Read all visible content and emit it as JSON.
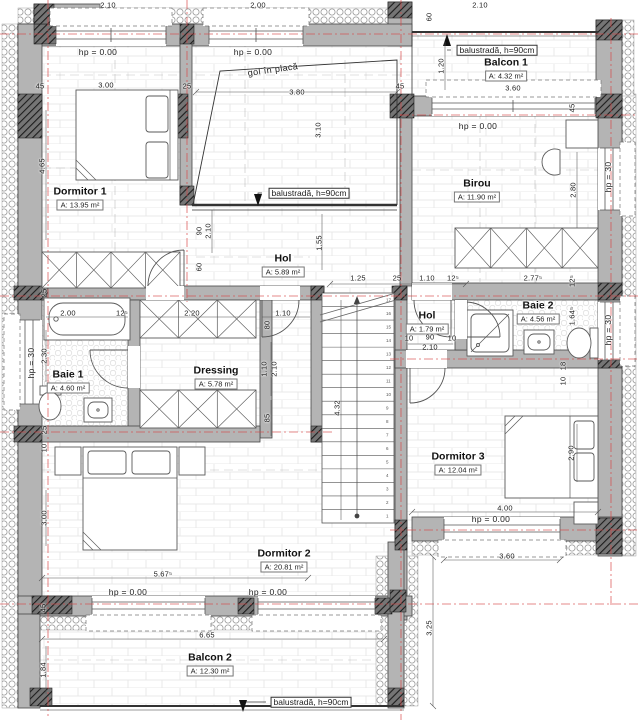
{
  "plan": {
    "title": "etaj floor plan",
    "rooms": [
      {
        "name": "Dormitor 1",
        "area": "A: 13.95 m²",
        "cx": 80,
        "cy": 198
      },
      {
        "name": "Balcon 1",
        "area": "A: 4.32 m²",
        "cx": 506,
        "cy": 69
      },
      {
        "name": "Birou",
        "area": "A: 11.90 m²",
        "cx": 477,
        "cy": 190
      },
      {
        "name": "Hol",
        "area": "A: 5.89 m²",
        "cx": 283,
        "cy": 265
      },
      {
        "name": "Baie 1",
        "area": "A: 4.60 m²",
        "cx": 68,
        "cy": 381
      },
      {
        "name": "Dressing",
        "area": "A: 5.78 m²",
        "cx": 216,
        "cy": 377
      },
      {
        "name": "Hol",
        "area": "A: 1.79 m²",
        "cx": 427,
        "cy": 322
      },
      {
        "name": "Baie 2",
        "area": "A: 4.56 m²",
        "cx": 538,
        "cy": 312
      },
      {
        "name": "Dormitor 3",
        "area": "A: 12.04 m²",
        "cx": 458,
        "cy": 463
      },
      {
        "name": "Dormitor 2",
        "area": "A: 20.81 m²",
        "cx": 284,
        "cy": 560
      },
      {
        "name": "Balcon 2",
        "area": "A: 12.30 m²",
        "cx": 210,
        "cy": 664
      }
    ],
    "labels": [
      {
        "t": "2.10",
        "x": 108,
        "y": 5,
        "cls": "dim"
      },
      {
        "t": "2.00",
        "x": 258,
        "y": 5,
        "cls": "dim"
      },
      {
        "t": "2.10",
        "x": 480,
        "y": 5,
        "cls": "dim"
      },
      {
        "t": "45",
        "x": 40,
        "y": 86,
        "cls": "dim"
      },
      {
        "t": "3.00",
        "x": 106,
        "y": 85,
        "cls": "dim"
      },
      {
        "t": "25",
        "x": 187,
        "y": 86,
        "cls": "dim"
      },
      {
        "t": "3.80",
        "x": 297,
        "y": 92,
        "cls": "dim"
      },
      {
        "t": "45",
        "x": 400,
        "y": 86,
        "cls": "dim"
      },
      {
        "t": "60",
        "x": 429,
        "y": 17,
        "r": -90,
        "cls": "dim"
      },
      {
        "t": "1.20",
        "x": 441,
        "y": 66,
        "r": -90,
        "cls": "dim"
      },
      {
        "t": "3.60",
        "x": 513,
        "y": 88,
        "cls": "dim"
      },
      {
        "t": "45",
        "x": 572,
        "y": 108,
        "r": -90,
        "cls": "dim"
      },
      {
        "t": "4.65",
        "x": 42,
        "y": 166,
        "r": -90,
        "cls": "dim"
      },
      {
        "t": "3.10",
        "x": 318,
        "y": 130,
        "r": -90,
        "cls": "dim"
      },
      {
        "t": "2.80",
        "x": 573,
        "y": 190,
        "r": -90,
        "cls": "dim"
      },
      {
        "t": "90",
        "x": 199,
        "y": 231,
        "r": -90,
        "cls": "dim"
      },
      {
        "t": "2.10",
        "x": 208,
        "y": 231,
        "r": -90,
        "cls": "dim"
      },
      {
        "t": "60",
        "x": 199,
        "y": 267,
        "r": -90,
        "cls": "dim"
      },
      {
        "t": "1.55",
        "x": 319,
        "y": 243,
        "r": -90,
        "cls": "dim"
      },
      {
        "t": "1.25",
        "x": 358,
        "y": 278,
        "cls": "dim"
      },
      {
        "t": "25",
        "x": 397,
        "y": 278,
        "cls": "dim"
      },
      {
        "t": "1.10",
        "x": 427,
        "y": 278,
        "cls": "dim"
      },
      {
        "t": "12⁵",
        "x": 453,
        "y": 278,
        "cls": "dim"
      },
      {
        "t": "2.77⁵",
        "x": 533,
        "y": 278,
        "cls": "dim"
      },
      {
        "t": "12⁵",
        "x": 572,
        "y": 281,
        "r": -90,
        "cls": "dim"
      },
      {
        "t": "1.64⁵",
        "x": 572,
        "y": 316,
        "r": -90,
        "cls": "dim"
      },
      {
        "t": "25",
        "x": 44,
        "y": 293,
        "r": -90,
        "cls": "dim"
      },
      {
        "t": "2.00",
        "x": 68,
        "y": 313,
        "cls": "dim"
      },
      {
        "t": "12⁵",
        "x": 122,
        "y": 313,
        "cls": "dim"
      },
      {
        "t": "2.20",
        "x": 192,
        "y": 313,
        "cls": "dim"
      },
      {
        "t": "1.10",
        "x": 283,
        "y": 313,
        "cls": "dim"
      },
      {
        "t": "80",
        "x": 267,
        "y": 325,
        "r": -90,
        "cls": "dim"
      },
      {
        "t": "2.30",
        "x": 44,
        "y": 356,
        "r": -90,
        "cls": "dim"
      },
      {
        "t": "1.10",
        "x": 264,
        "y": 369,
        "r": -90,
        "cls": "dim"
      },
      {
        "t": "2.10",
        "x": 274,
        "y": 369,
        "r": -90,
        "cls": "dim"
      },
      {
        "t": "85",
        "x": 267,
        "y": 418,
        "r": -90,
        "cls": "dim"
      },
      {
        "t": "10",
        "x": 409,
        "y": 338,
        "cls": "dim"
      },
      {
        "t": "90",
        "x": 430,
        "y": 337,
        "cls": "dim"
      },
      {
        "t": "10",
        "x": 452,
        "y": 338,
        "cls": "dim"
      },
      {
        "t": "2.10",
        "x": 430,
        "y": 347,
        "cls": "dim"
      },
      {
        "t": "18",
        "x": 563,
        "y": 366,
        "r": -90,
        "cls": "dim"
      },
      {
        "t": "10",
        "x": 563,
        "y": 381,
        "r": -90,
        "cls": "dim"
      },
      {
        "t": "4.32",
        "x": 337,
        "y": 408,
        "r": -90,
        "cls": "dim"
      },
      {
        "t": "25",
        "x": 44,
        "y": 430,
        "r": -90,
        "cls": "dim"
      },
      {
        "t": "10",
        "x": 44,
        "y": 448,
        "r": -90,
        "cls": "dim"
      },
      {
        "t": "2.90",
        "x": 571,
        "y": 453,
        "r": -90,
        "cls": "dim"
      },
      {
        "t": "4.00",
        "x": 505,
        "y": 508,
        "cls": "dim"
      },
      {
        "t": "3.00",
        "x": 44,
        "y": 518,
        "r": -90,
        "cls": "dim"
      },
      {
        "t": "3.60",
        "x": 507,
        "y": 556,
        "cls": "dim"
      },
      {
        "t": "5.67⁵",
        "x": 163,
        "y": 574,
        "cls": "dim"
      },
      {
        "t": "45",
        "x": 43,
        "y": 608,
        "r": -90,
        "cls": "dim"
      },
      {
        "t": "3.25",
        "x": 429,
        "y": 628,
        "r": -90,
        "cls": "dim"
      },
      {
        "t": "6.65",
        "x": 207,
        "y": 635,
        "cls": "dim"
      },
      {
        "t": "1.84",
        "x": 43,
        "y": 670,
        "r": -90,
        "cls": "dim"
      },
      {
        "t": "hp = 0.00",
        "x": 98,
        "y": 52,
        "cls": "hp"
      },
      {
        "t": "hp = 0.00",
        "x": 253,
        "y": 52,
        "cls": "hp"
      },
      {
        "t": "hp = 0.00",
        "x": 478,
        "y": 126,
        "cls": "hp"
      },
      {
        "t": "hp = 0.00",
        "x": 491,
        "y": 519,
        "cls": "hp"
      },
      {
        "t": "hp = 0.00",
        "x": 128,
        "y": 592,
        "cls": "hp"
      },
      {
        "t": "hp = 0.00",
        "x": 268,
        "y": 592,
        "cls": "hp"
      },
      {
        "t": "hp = 30",
        "x": 31,
        "y": 363,
        "r": -90,
        "cls": "hp"
      },
      {
        "t": "hp = 30",
        "x": 608,
        "y": 177,
        "r": -90,
        "cls": "hp"
      },
      {
        "t": "hp = 30",
        "x": 608,
        "y": 330,
        "r": -90,
        "cls": "hp"
      },
      {
        "t": "gol în placă",
        "x": 273,
        "y": 70,
        "r": -8,
        "cls": "note"
      },
      {
        "t": "balustradă, h=90cm",
        "x": 309,
        "y": 193,
        "cls": "callout"
      },
      {
        "t": "balustradă, h=90cm",
        "x": 497,
        "y": 50,
        "cls": "callout"
      },
      {
        "t": "balustradă, h=90cm",
        "x": 311,
        "y": 702,
        "cls": "callout"
      }
    ],
    "stairs": {
      "steps": 17
    },
    "colors": {
      "wall": "#b4b4b4",
      "axis_red": "#d84848",
      "hatch_dark": "#1d1d1d",
      "line": "#555555"
    }
  }
}
